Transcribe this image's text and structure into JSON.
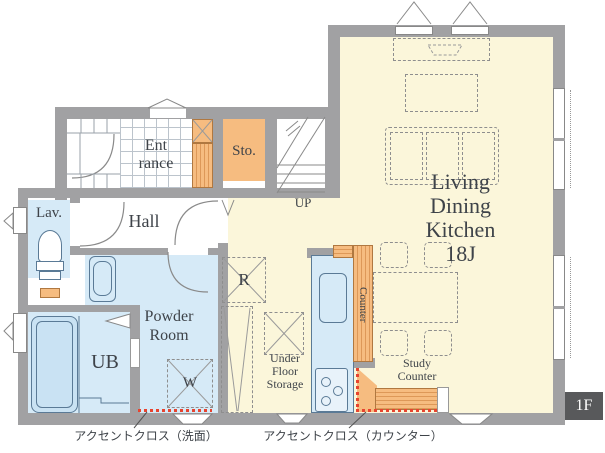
{
  "floor_badge": "1F",
  "rooms": {
    "ldk": {
      "lines": [
        "Living",
        "Dining",
        "Kitchen",
        "18J"
      ]
    },
    "entrance": {
      "lines": [
        "Ent",
        "rance"
      ]
    },
    "storage": "Sto.",
    "hall": "Hall",
    "lavatory": "Lav.",
    "unit_bath": "UB",
    "powder_room": {
      "lines": [
        "Powder",
        "Room"
      ]
    },
    "stairs_up": "UP"
  },
  "fixtures": {
    "refrigerator": "R",
    "washer": "W",
    "under_floor_storage": {
      "lines": [
        "Under",
        "Floor",
        "Storage"
      ]
    },
    "kitchen_counter": "Counter",
    "study_counter": {
      "lines": [
        "Study",
        "Counter"
      ]
    }
  },
  "annotations": {
    "accent_cloth_basin": "アクセントクロス（洗面）",
    "accent_cloth_counter": "アクセントクロス（カウンター）"
  },
  "colors": {
    "wall": "#A1A1A3",
    "ldk_floor": "#FBF6DA",
    "wet_room_floor": "#D6EAF7",
    "wood_counter": "#F6BC80",
    "accent_red": "#E8432E",
    "badge_bg": "#58595B",
    "text": "#3E4349"
  }
}
